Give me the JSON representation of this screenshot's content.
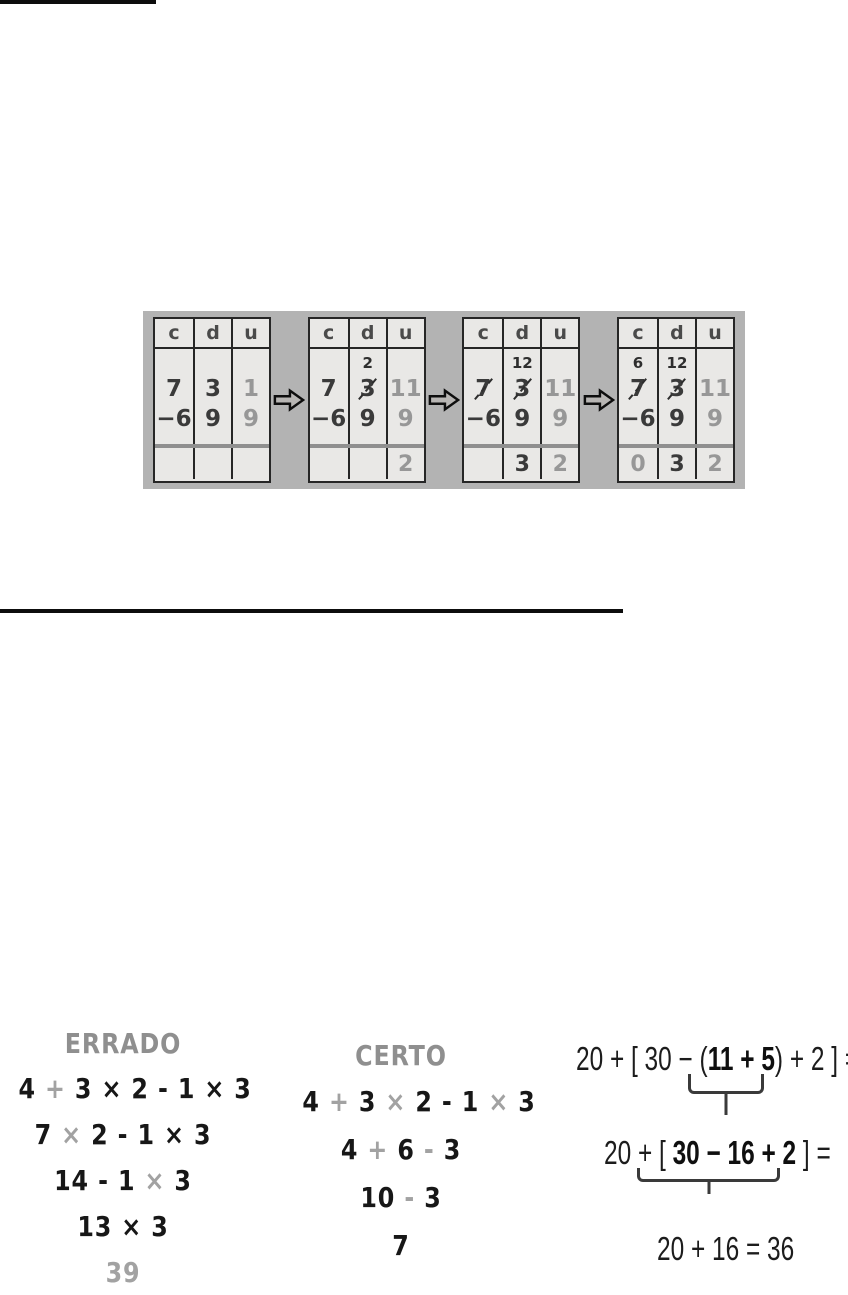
{
  "colors": {
    "figure_background": "#b3b3b3",
    "panel_background": "#e9e8e6",
    "digit_dark": "#3a3a3a",
    "digit_gray": "#979797",
    "hand_gray": "#8f8f8f",
    "ink_black": "#0d0d0d"
  },
  "subtraction_figure": {
    "headers": [
      "c",
      "d",
      "u"
    ],
    "arrow_icon": "right-arrow",
    "panels": [
      {
        "carry": [
          {
            "t": ""
          },
          {
            "t": ""
          },
          {
            "t": ""
          }
        ],
        "minuend": [
          {
            "t": "7"
          },
          {
            "t": "3"
          },
          {
            "t": "1",
            "g": true
          }
        ],
        "subtrahend": [
          {
            "t": "−6"
          },
          {
            "t": "9"
          },
          {
            "t": "9",
            "g": true
          }
        ],
        "result": [
          {
            "t": ""
          },
          {
            "t": ""
          },
          {
            "t": ""
          }
        ]
      },
      {
        "carry": [
          {
            "t": ""
          },
          {
            "t": "2"
          },
          {
            "t": ""
          }
        ],
        "minuend": [
          {
            "t": "7"
          },
          {
            "t": "3",
            "s": true
          },
          {
            "t": "11",
            "g": true
          }
        ],
        "subtrahend": [
          {
            "t": "−6"
          },
          {
            "t": "9"
          },
          {
            "t": "9",
            "g": true
          }
        ],
        "result": [
          {
            "t": ""
          },
          {
            "t": ""
          },
          {
            "t": "2",
            "g": true
          }
        ]
      },
      {
        "carry": [
          {
            "t": ""
          },
          {
            "t": "12"
          },
          {
            "t": ""
          }
        ],
        "minuend": [
          {
            "t": "7",
            "s": true
          },
          {
            "t": "3",
            "s": true
          },
          {
            "t": "11",
            "g": true
          }
        ],
        "subtrahend": [
          {
            "t": "−6"
          },
          {
            "t": "9"
          },
          {
            "t": "9",
            "g": true
          }
        ],
        "result": [
          {
            "t": ""
          },
          {
            "t": "3"
          },
          {
            "t": "2",
            "g": true
          }
        ]
      },
      {
        "carry": [
          {
            "t": "6"
          },
          {
            "t": "12"
          },
          {
            "t": ""
          }
        ],
        "minuend": [
          {
            "t": "7",
            "s": true
          },
          {
            "t": "3",
            "s": true
          },
          {
            "t": "11",
            "g": true
          }
        ],
        "subtrahend": [
          {
            "t": "−6"
          },
          {
            "t": "9"
          },
          {
            "t": "9",
            "g": true
          }
        ],
        "result": [
          {
            "t": "0",
            "g": true
          },
          {
            "t": "3"
          },
          {
            "t": "2",
            "g": true
          }
        ]
      }
    ]
  },
  "errado": {
    "title": "ERRADO",
    "lines": [
      [
        {
          "t": "4 "
        },
        {
          "t": "+",
          "g": true
        },
        {
          "t": " 3 × 2 - 1 × 3"
        }
      ],
      [
        {
          "t": "7 "
        },
        {
          "t": "×",
          "g": true
        },
        {
          "t": " 2 - 1 × 3"
        }
      ],
      [
        {
          "t": "14 - 1 "
        },
        {
          "t": "×",
          "g": true
        },
        {
          "t": " 3"
        }
      ],
      [
        {
          "t": "13 × 3"
        }
      ],
      [
        {
          "t": "39",
          "g": true
        }
      ]
    ]
  },
  "certo": {
    "title": "CERTO",
    "lines": [
      [
        {
          "t": "4 "
        },
        {
          "t": "+",
          "g": true
        },
        {
          "t": " 3 "
        },
        {
          "t": "×",
          "g": true
        },
        {
          "t": " 2 - 1 "
        },
        {
          "t": "×",
          "g": true
        },
        {
          "t": " 3"
        }
      ],
      [
        {
          "t": "4 "
        },
        {
          "t": "+",
          "g": true
        },
        {
          "t": " 6 "
        },
        {
          "t": "-",
          "g": true
        },
        {
          "t": " 3"
        }
      ],
      [
        {
          "t": "10 "
        },
        {
          "t": "-",
          "g": true
        },
        {
          "t": " 3"
        }
      ],
      [
        {
          "t": "7"
        }
      ]
    ]
  },
  "brackets_example": {
    "line1": [
      {
        "t": "20 + [ 30 − ("
      },
      {
        "t": "11 + 5",
        "b": true
      },
      {
        "t": ") + 2 ] ="
      }
    ],
    "line2": [
      {
        "t": "20 + [ "
      },
      {
        "t": "30 − 16 + 2",
        "b": true
      },
      {
        "t": " ] ="
      }
    ],
    "line3": [
      {
        "t": "20 + 16 = 36"
      }
    ]
  }
}
